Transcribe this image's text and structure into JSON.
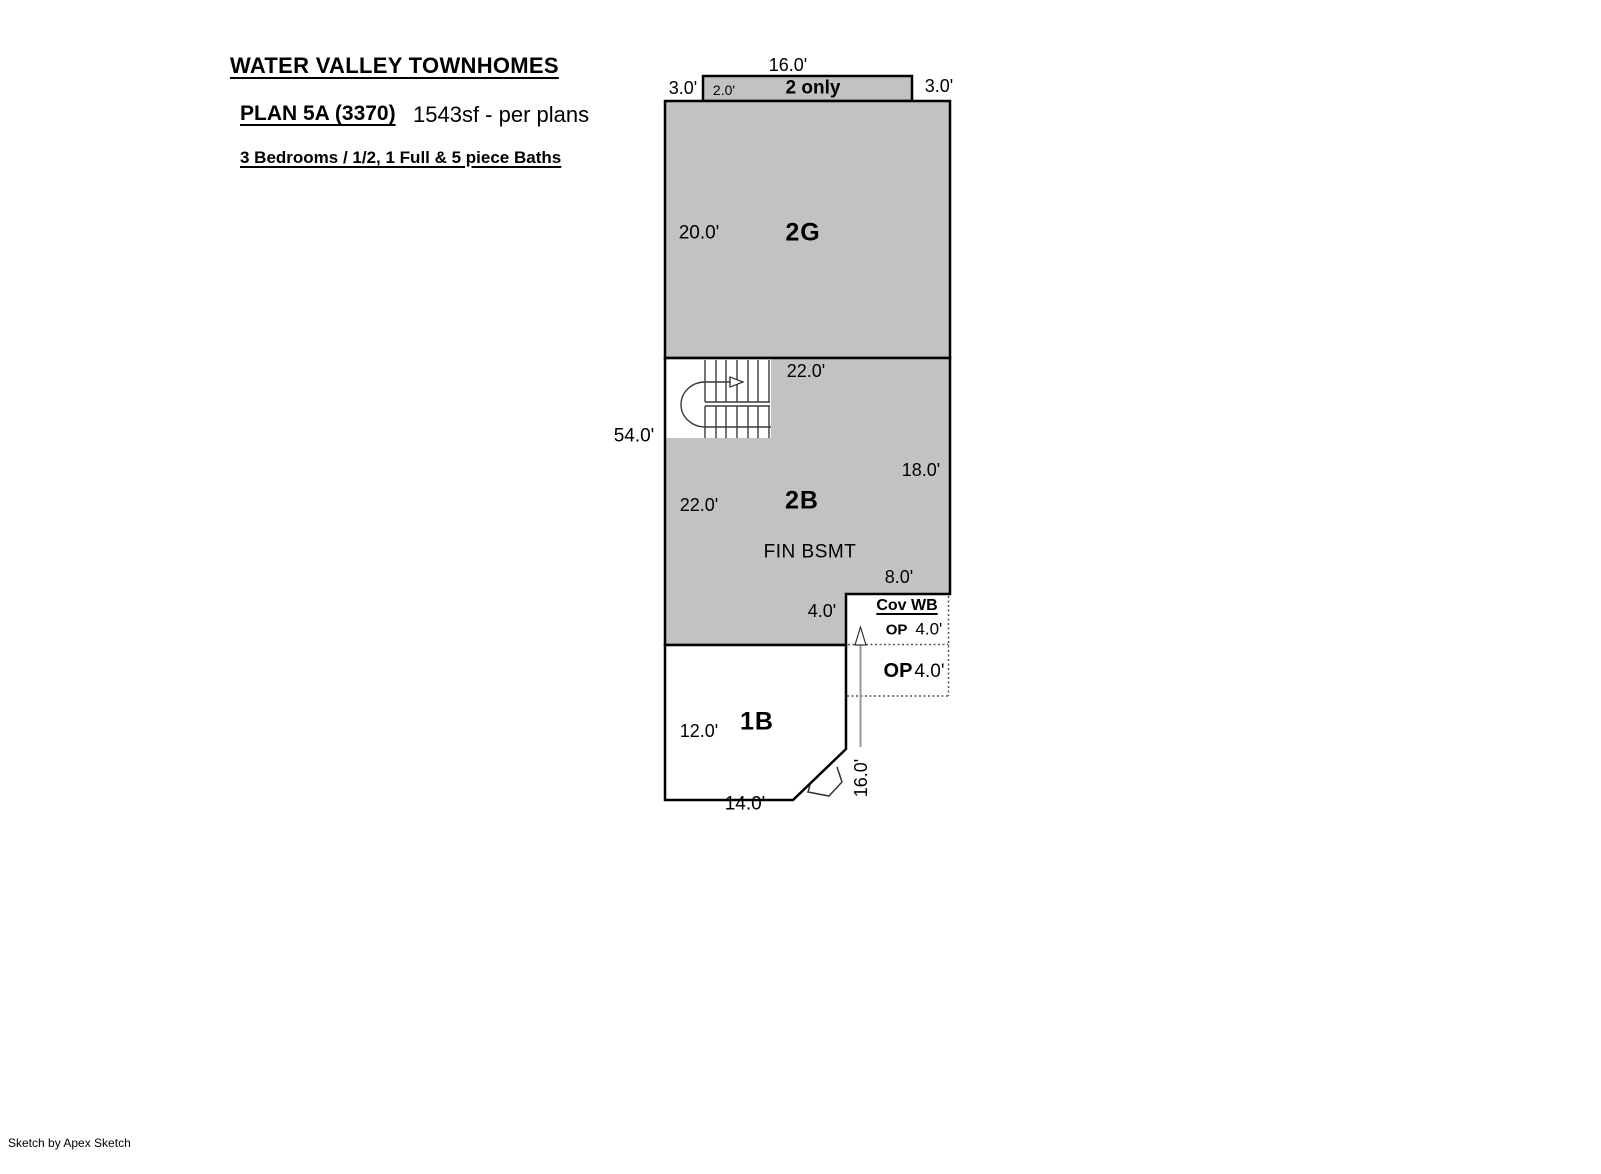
{
  "header": {
    "title": "WATER VALLEY TOWNHOMES",
    "plan": "PLAN 5A (3370)",
    "area": "1543sf - per plans",
    "details": "3 Bedrooms / 1/2, 1 Full & 5 piece Baths"
  },
  "colors": {
    "area_fill": "#c2c2c2",
    "line": "#000000"
  },
  "plan": {
    "strip": {
      "label": "2 only",
      "width": "16.0'",
      "left": "3.0'",
      "right": "3.0'",
      "depth": "2.0'"
    },
    "garage": {
      "label": "2G",
      "height": "20.0'"
    },
    "upper": {
      "label": "2B",
      "note": "FIN BSMT",
      "stair_width": "22.0'",
      "height_left": "22.0'",
      "height_right": "18.0'",
      "notch_width": "8.0'",
      "notch_height": "4.0'"
    },
    "overall_height": "54.0'",
    "covwb": {
      "label": "Cov WB",
      "op_label": "OP",
      "op_depth": "4.0'"
    },
    "op": {
      "label": "OP",
      "depth": "4.0'"
    },
    "lower": {
      "label": "1B",
      "height": "12.0'",
      "width": "14.0'"
    },
    "porch_height": "16.0'"
  },
  "footer": {
    "credit": "Sketch by Apex Sketch"
  }
}
